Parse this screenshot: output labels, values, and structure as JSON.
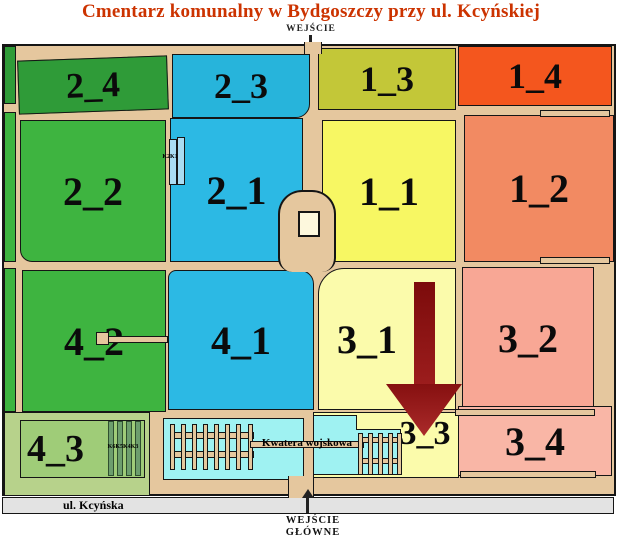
{
  "title": {
    "text": "Cmentarz komunalny w Bydgoszczy przy ul. Kcyńskiej",
    "color": "#cc3300"
  },
  "top_entrance": {
    "label": "WEJŚCIE"
  },
  "main_entrance": {
    "line1": "WEJŚCIE",
    "line2": "GŁÓWNE"
  },
  "street": {
    "label": "ul. Kcyńska"
  },
  "sections": {
    "s24": {
      "label": "2_4",
      "color": "#2f9b38"
    },
    "s23": {
      "label": "2_3",
      "color": "#27b4db"
    },
    "s13": {
      "label": "1_3",
      "color": "#c3c738"
    },
    "s14": {
      "label": "1_4",
      "color": "#f4561e"
    },
    "s22": {
      "label": "2_2",
      "color": "#3eb440"
    },
    "s21": {
      "label": "2_1",
      "color": "#2cb9e4"
    },
    "s11": {
      "label": "1_1",
      "color": "#f7f763"
    },
    "s12": {
      "label": "1_2",
      "color": "#f28a62"
    },
    "s42": {
      "label": "4_2",
      "color": "#3eb440"
    },
    "s41": {
      "label": "4_1",
      "color": "#2cb9e4"
    },
    "s31": {
      "label": "3_1",
      "color": "#fbfbab"
    },
    "s32": {
      "label": "3_2",
      "color": "#f8a795"
    },
    "s43": {
      "label": "4_3",
      "color": "#9fcc78"
    },
    "s33": {
      "label": "3_3",
      "color": "#fbfbab"
    },
    "s34": {
      "label": "3_4",
      "color": "#f9b6a6"
    }
  },
  "structures": {
    "k2k1_label": "K2K1",
    "k6k5k4k3_label": "K6K5K4K3",
    "military_label": "Kwatera wojskowa"
  },
  "map_colors": {
    "path_tan": "#e5c79e",
    "military_cyan": "#9ff2f2",
    "building_cream": "#fdf8dd",
    "road_gray": "#e3e3e3",
    "arrow_dark_red": "#7c0b0b",
    "arrow_light_red": "#aa2a2a",
    "outline_black": "#151515"
  }
}
